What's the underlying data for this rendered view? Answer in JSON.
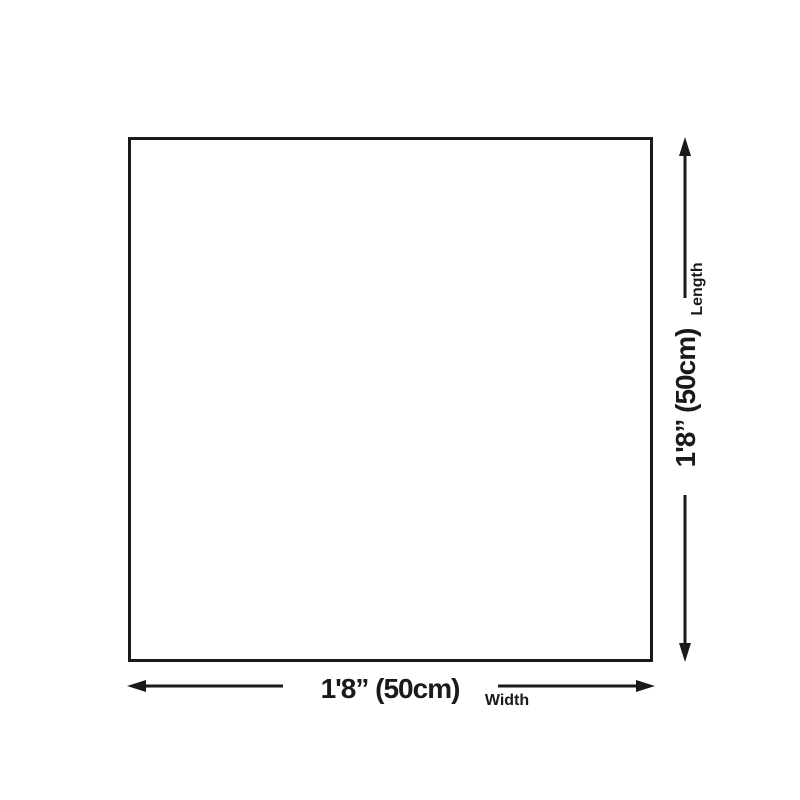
{
  "diagram": {
    "type": "product-dimension-diagram",
    "shape": "square",
    "background_color": "#ffffff",
    "line_color": "#1a1a1a",
    "dimensions": {
      "width": {
        "label": "Width",
        "value": "1'8” (50cm)",
        "orientation": "horizontal"
      },
      "length": {
        "label": "Length",
        "value": "1'8” (50cm)",
        "orientation": "vertical"
      }
    },
    "icons": {
      "width_arrow_left": "arrow-left-icon",
      "width_arrow_right": "arrow-right-icon",
      "length_arrow_up": "arrow-up-icon",
      "length_arrow_down": "arrow-down-icon"
    }
  }
}
